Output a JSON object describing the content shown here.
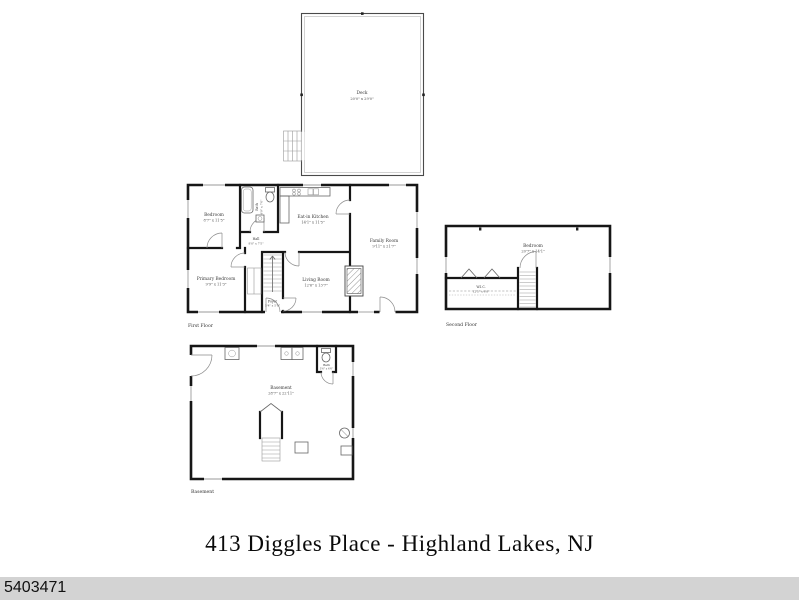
{
  "title": "413 Diggles Place - Highland Lakes, NJ",
  "listing_id": "5403471",
  "colors": {
    "footer_bar": "#d3d3d3",
    "wall": "#161616"
  },
  "floors": {
    "deck": {
      "room": {
        "name": "Deck",
        "dims": "20'0\" x 29'0\""
      }
    },
    "first": {
      "label": "First Floor",
      "rooms": {
        "bedroom": {
          "name": "Bedroom",
          "dims": "8'7\" x 11'5\""
        },
        "bath": {
          "name": "Bath",
          "dims": "4'9\" x 7'0\""
        },
        "hall": {
          "name": "Hall",
          "dims": "8'0\" x 7'5\""
        },
        "kitchen": {
          "name": "Eat-in Kitchen",
          "dims": "14'1\" x 11'5\""
        },
        "family_room": {
          "name": "Family Room",
          "dims": "9'11\" x 21'7\""
        },
        "primary_bedroom": {
          "name": "Primary Bedroom",
          "dims": "9'9\" x 11'3\""
        },
        "living_room": {
          "name": "Living Room",
          "dims": "12'6\" x 13'7\""
        },
        "foyer": {
          "name": "Foyer",
          "dims": "5'4\" x 5'9\""
        }
      }
    },
    "second": {
      "label": "Second Floor",
      "rooms": {
        "bedroom": {
          "name": "Bedroom",
          "dims": "20'7\" x 14'1\""
        },
        "wic": {
          "name": "W.I.C.",
          "dims": "12'5\" x 6'0\""
        }
      }
    },
    "basement": {
      "label": "Basement",
      "rooms": {
        "main": {
          "name": "Basement",
          "dims": "28'7\" x 22'11\""
        },
        "bath": {
          "name": "Bath",
          "dims": "3'6\" x 6'6\""
        }
      }
    }
  }
}
